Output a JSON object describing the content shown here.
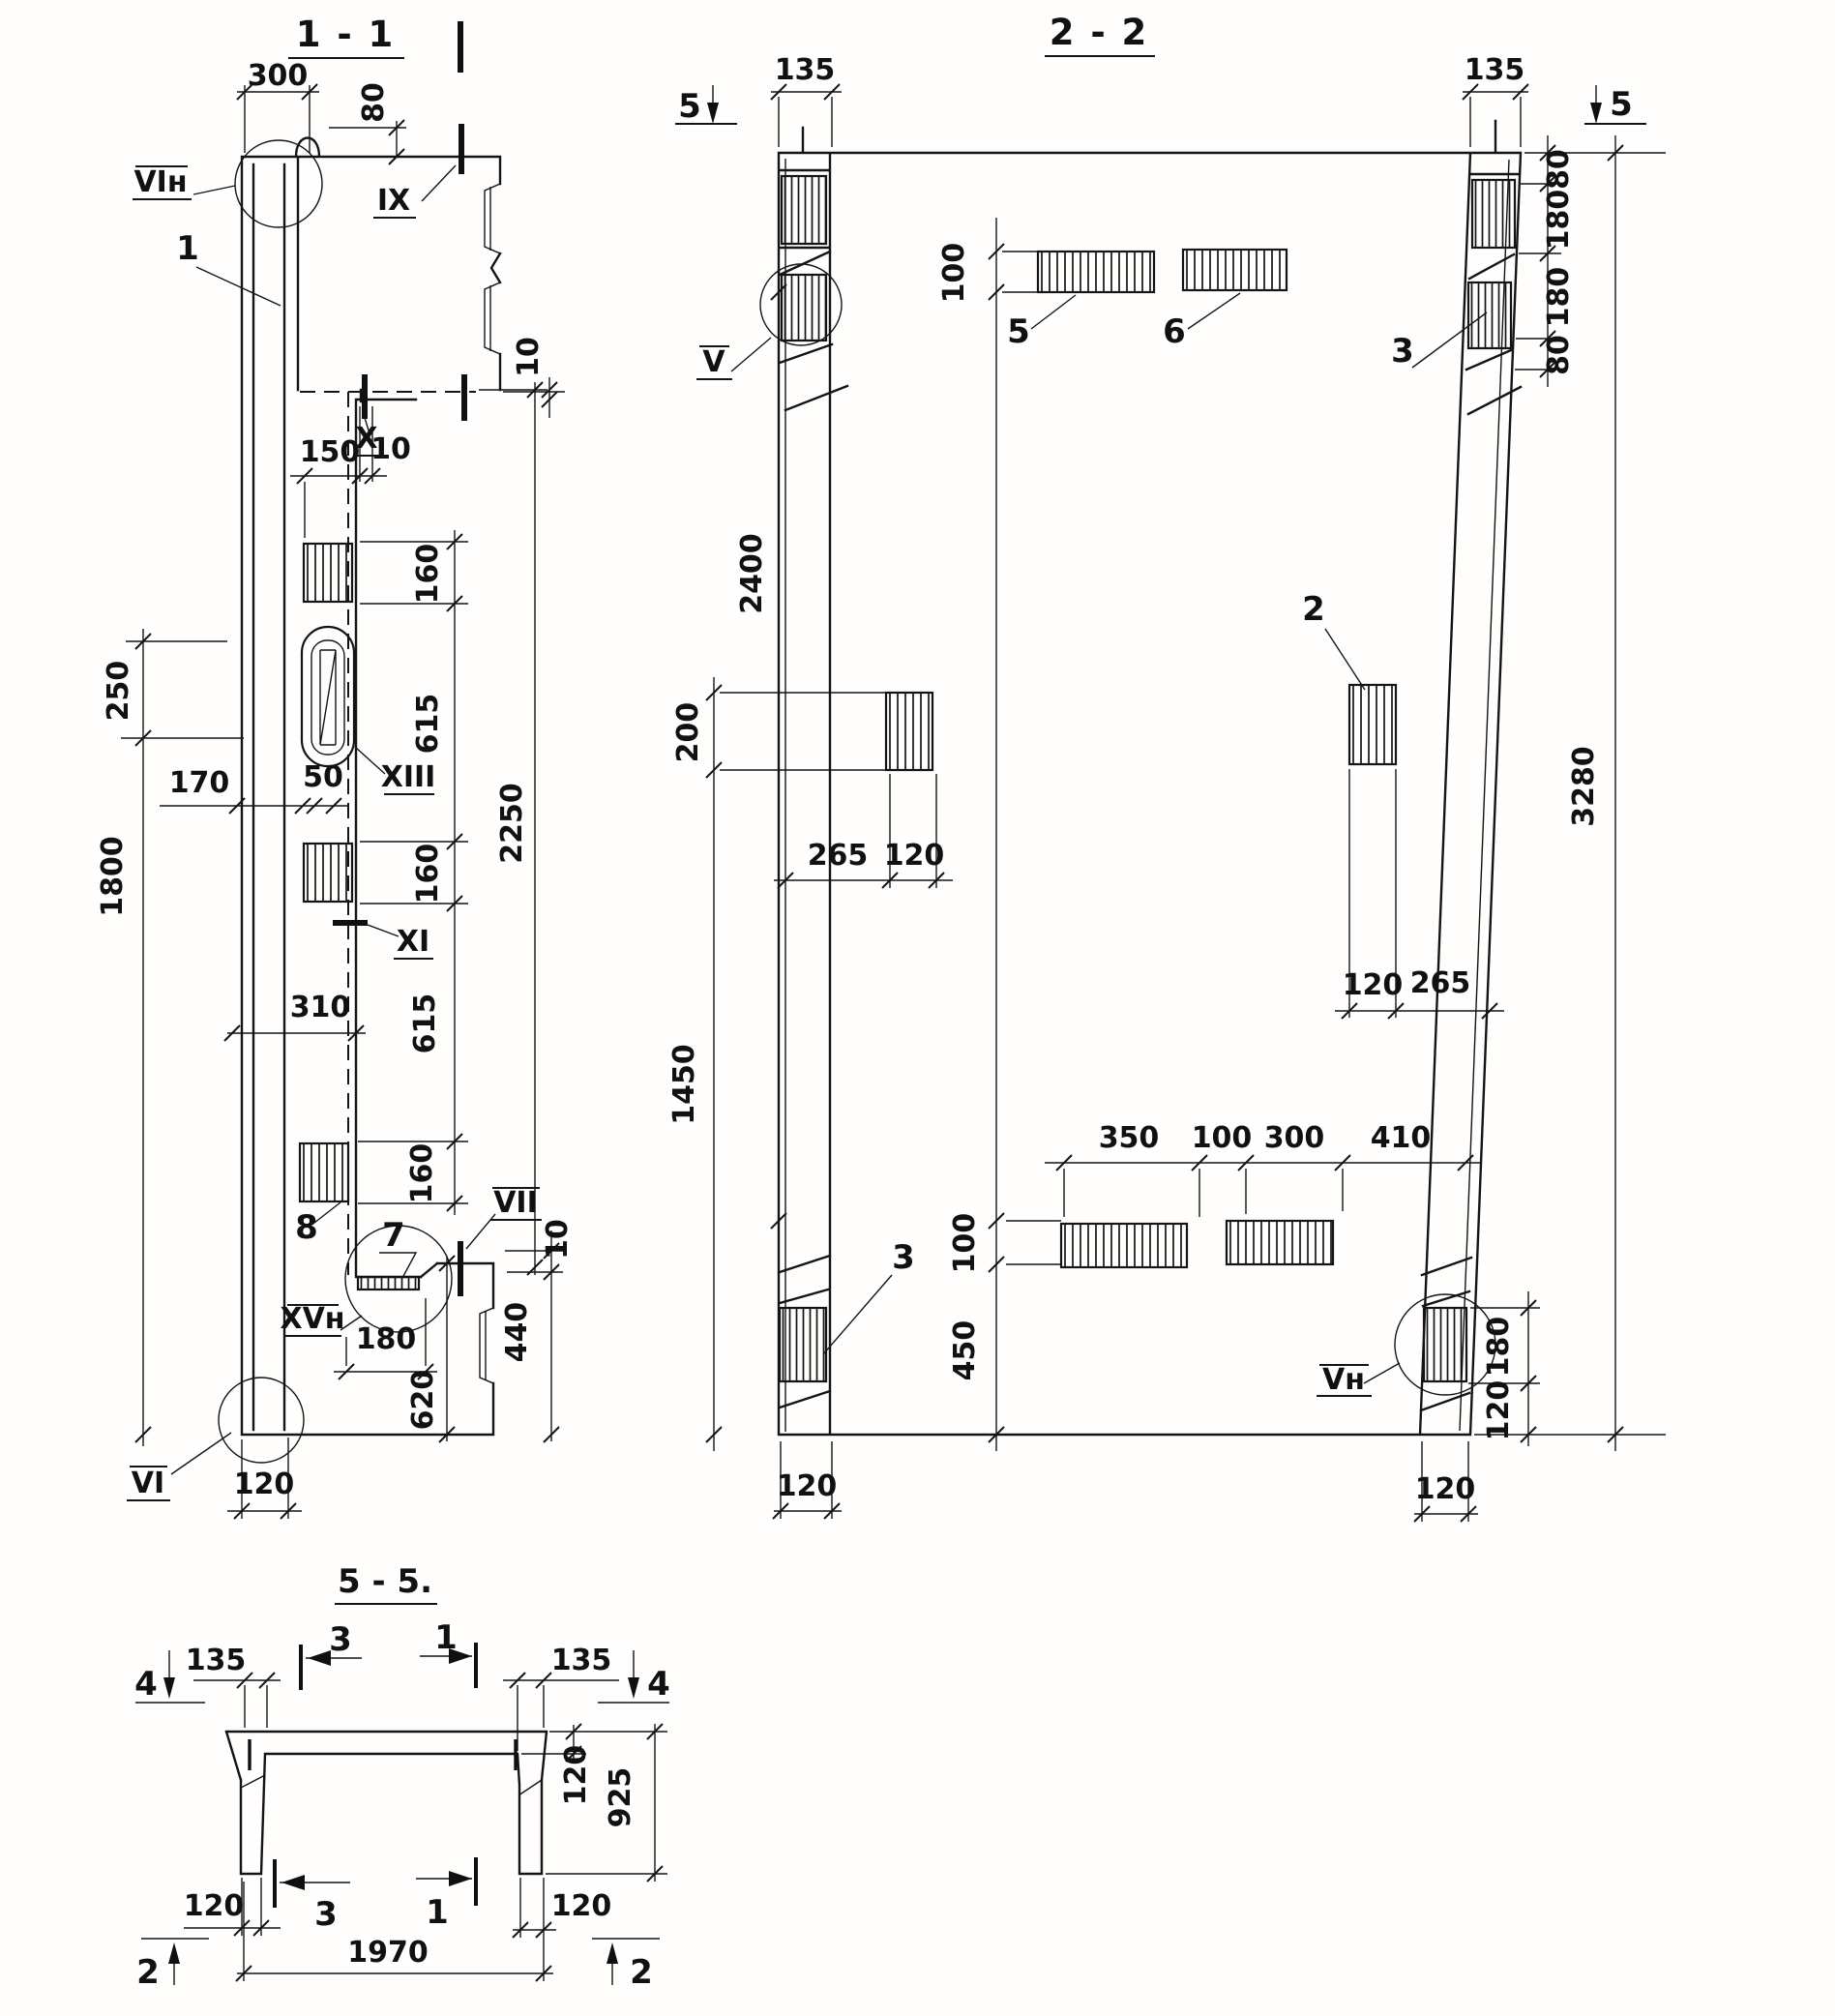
{
  "s11": {
    "title": "1 - 1",
    "dims": {
      "w300": "300",
      "h80": "80",
      "t10_top": "10",
      "w150": "150",
      "t10_mid": "10",
      "v250": "250",
      "v1800": "1800",
      "w170": "170",
      "w50": "50",
      "w310": "310",
      "c160a": "160",
      "c615a": "615",
      "c160b": "160",
      "c615b": "615",
      "c160c": "160",
      "v2250": "2250",
      "w180": "180",
      "v620": "620",
      "v440": "440",
      "t10_bot": "10",
      "w120": "120"
    },
    "labels": {
      "vi_top": "VIн",
      "ix": "IX",
      "x": "X",
      "xiii": "XIII",
      "xi": "XI",
      "vii": "VII",
      "xv": "XVн",
      "vi_bot": "VI",
      "p1": "1",
      "p7": "7",
      "p8": "8"
    }
  },
  "s22": {
    "title": "2 - 2",
    "dims": {
      "l135": "135",
      "r135": "135",
      "e80a": "80",
      "e180a": "180",
      "e180b": "180",
      "e80b": "80",
      "t100": "100",
      "v2400": "2400",
      "v200": "200",
      "v1450": "1450",
      "k265l": "265",
      "k120l": "120",
      "k120r": "120",
      "k265r": "265",
      "v3280": "3280",
      "b350": "350",
      "b100": "100",
      "b300": "300",
      "b410": "410",
      "bb100": "100",
      "v450": "450",
      "e180c": "180",
      "e120c": "120",
      "f120l": "120",
      "f120r": "120"
    },
    "labels": {
      "v": "V",
      "vn": "Vн",
      "p2": "2",
      "p3l": "3",
      "p3r": "3",
      "p5": "5",
      "p6": "6"
    },
    "markers": {
      "m5l": "5",
      "m5r": "5"
    }
  },
  "s55": {
    "title": "5 - 5.",
    "dims": {
      "l135": "135",
      "r135": "135",
      "t120": "120",
      "v925": "925",
      "f120l": "120",
      "f120r": "120",
      "w1970": "1970"
    },
    "markers": {
      "m4l": "4",
      "m4r": "4",
      "m2l": "2",
      "m2r": "2",
      "m3t": "3",
      "m1t": "1",
      "m3b": "3",
      "m1b": "1"
    }
  }
}
